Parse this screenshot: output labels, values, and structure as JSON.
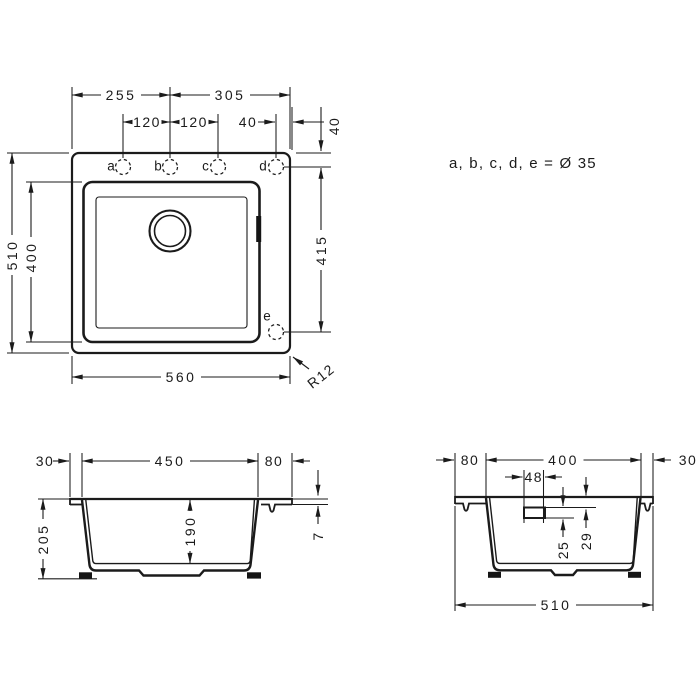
{
  "note": {
    "equation": "a, b, c, d, e = Ø 35"
  },
  "top_view": {
    "labels": {
      "a": "a",
      "b": "b",
      "c": "c",
      "d": "d",
      "e": "e"
    },
    "dims": {
      "left_to_hole_b": "255",
      "hole_b_to_right": "305",
      "hole_ab": "120",
      "hole_bc": "120",
      "hole_d_to_edge": "40",
      "top_edge_to_holes": "40",
      "hole_d_to_e": "415",
      "outer_depth": "510",
      "bowl_depth": "400",
      "outer_width": "560",
      "corner_radius": "R12"
    }
  },
  "front_section": {
    "dims": {
      "left_overhang": "30",
      "bowl_width": "450",
      "right_deck": "80",
      "total_height": "205",
      "bowl_inner_depth": "190",
      "rim_thickness": "7"
    }
  },
  "side_section": {
    "dims": {
      "rear_deck": "80",
      "bowl_width": "400",
      "front_overhang": "30",
      "overflow_width": "48",
      "overflow_height": "25",
      "overflow_top_to_rim": "29",
      "total_depth": "510"
    }
  }
}
